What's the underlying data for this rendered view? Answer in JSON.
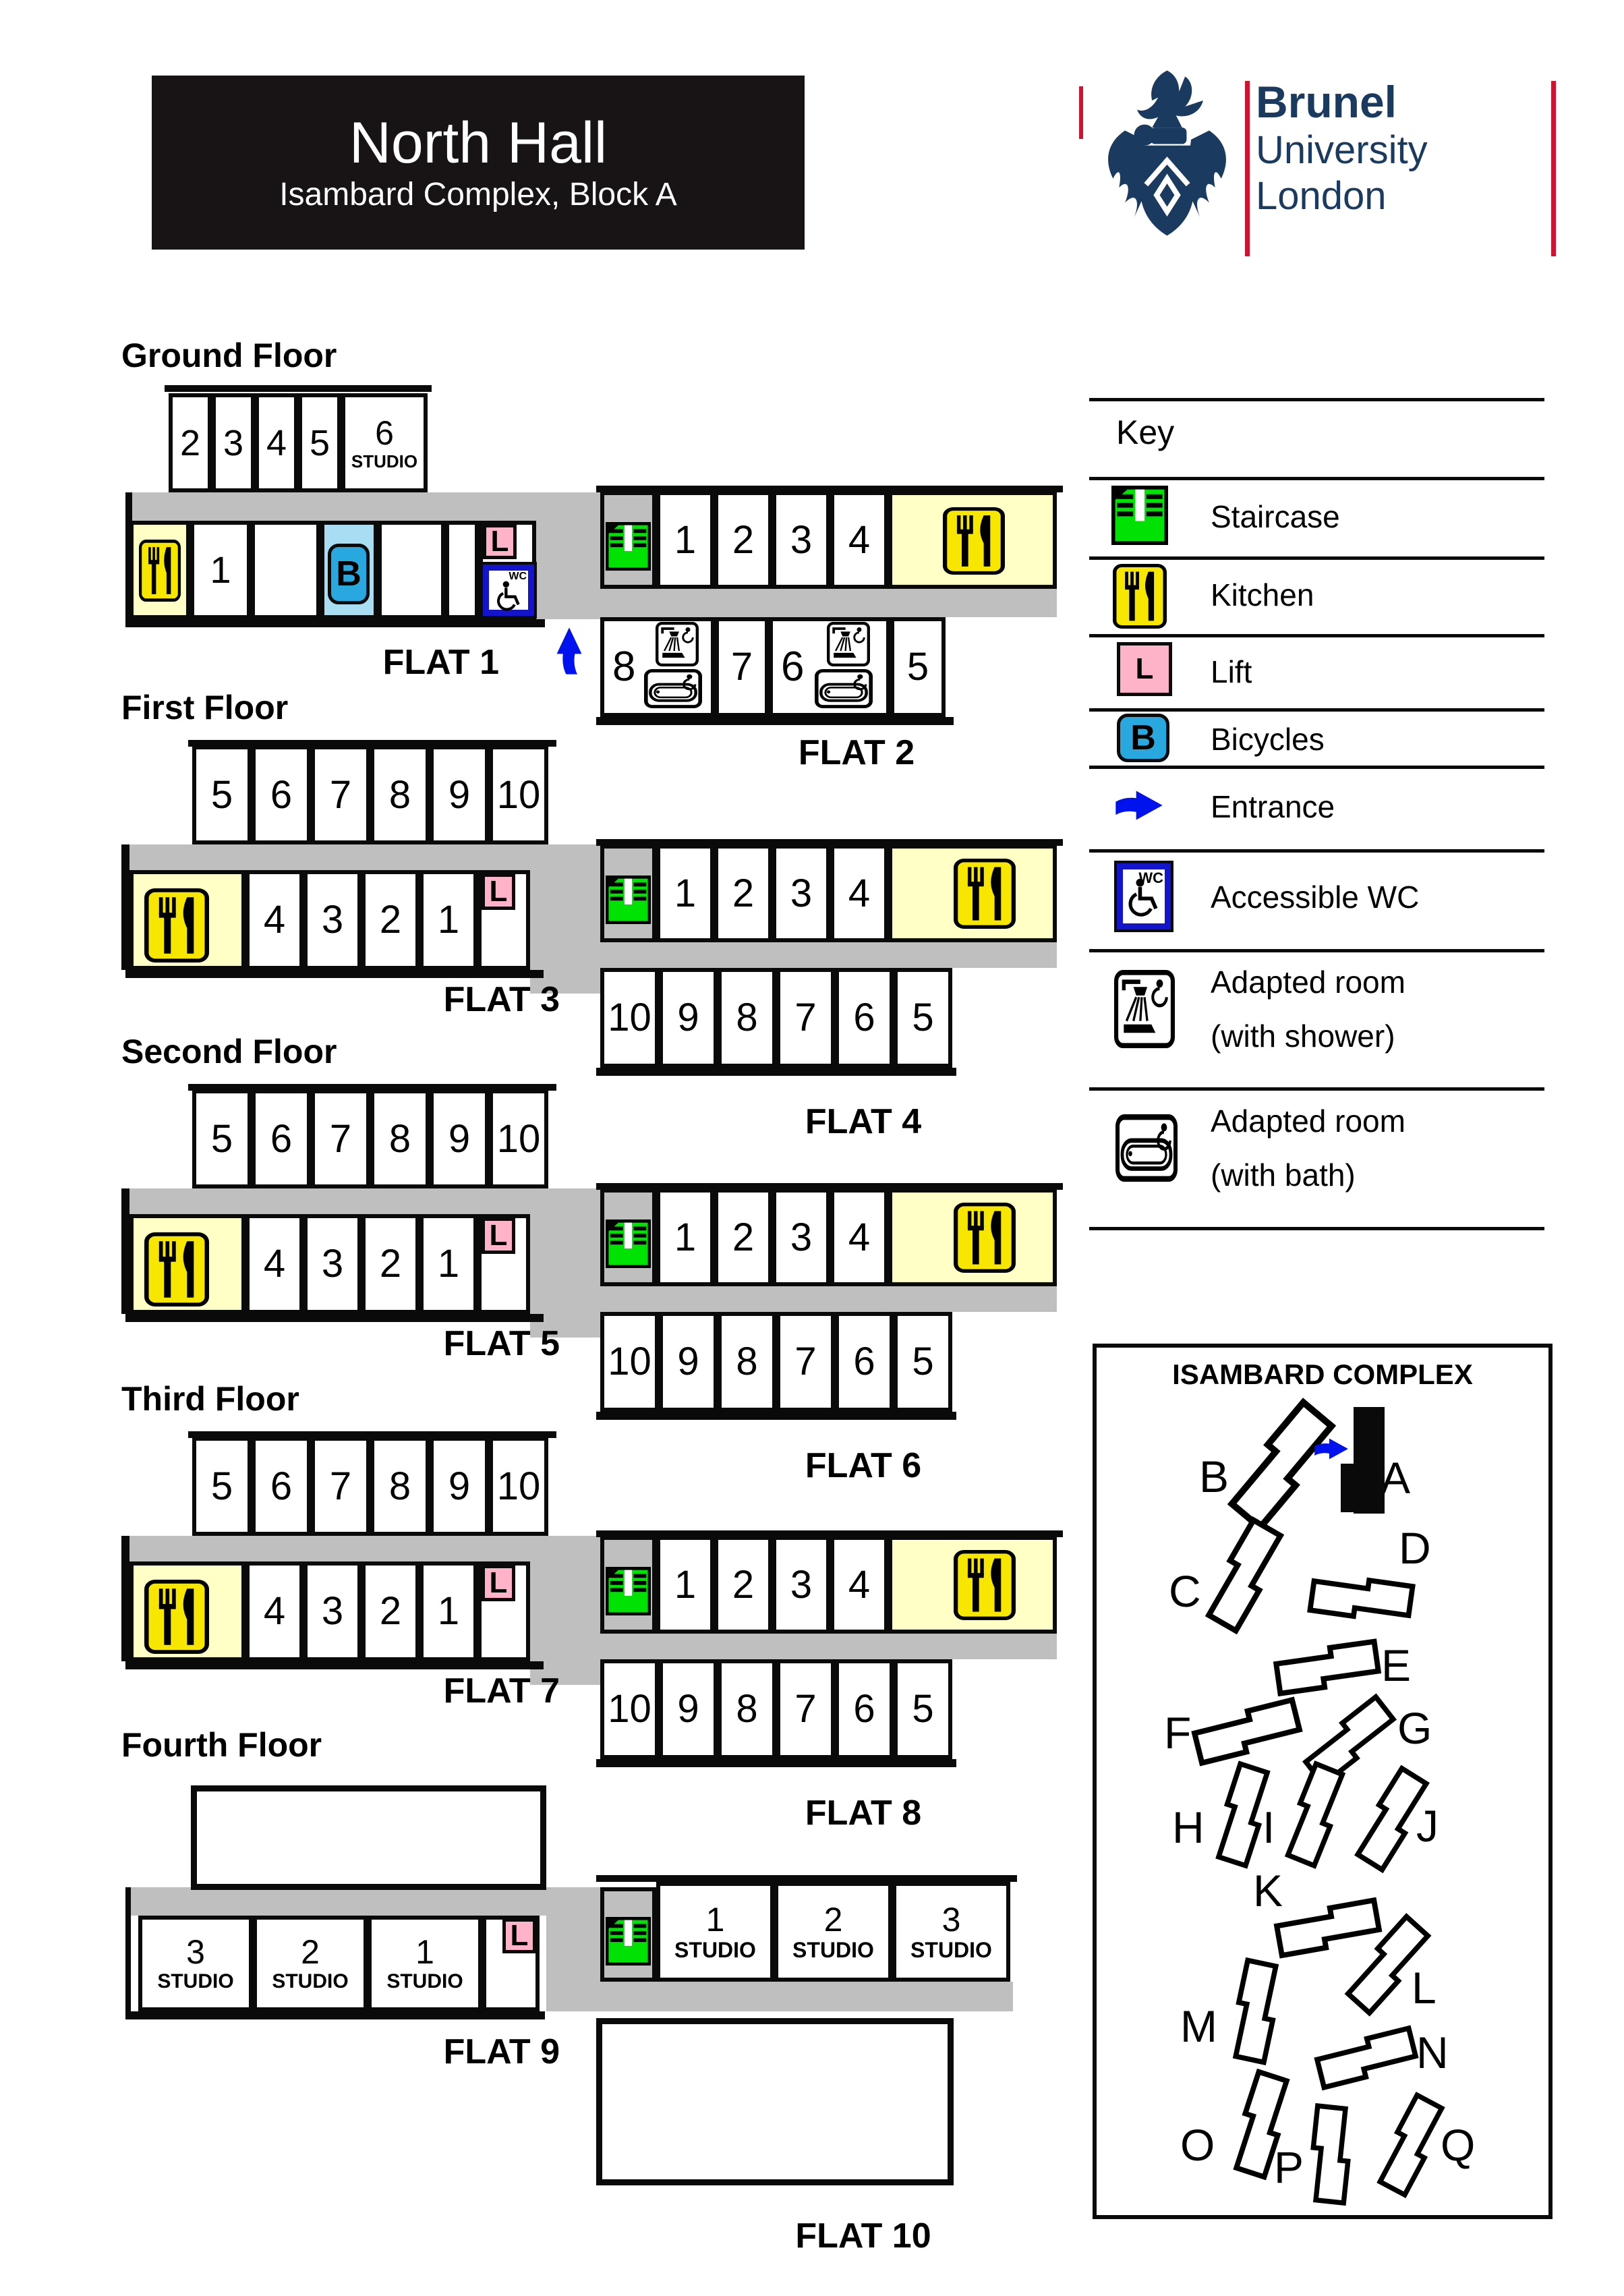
{
  "page": {
    "title": "North Hall",
    "subtitle": "Isambard Complex, Block A"
  },
  "logo": {
    "brand_lines": [
      "Brunel",
      "University",
      "London"
    ]
  },
  "key": {
    "heading": "Key",
    "items": [
      {
        "icon": "staircase-icon",
        "label": "Staircase"
      },
      {
        "icon": "kitchen-icon",
        "label": "Kitchen"
      },
      {
        "icon": "lift-icon",
        "label": "Lift",
        "glyph": "L"
      },
      {
        "icon": "bicycles-icon",
        "label": "Bicycles",
        "glyph": "B"
      },
      {
        "icon": "entrance-icon",
        "label": "Entrance"
      },
      {
        "icon": "accessible-wc-icon",
        "label": "Accessible WC",
        "glyph": "WC"
      },
      {
        "icon": "adapted-shower-icon",
        "label": "Adapted room",
        "label2": "(with shower)"
      },
      {
        "icon": "adapted-bath-icon",
        "label": "Adapted room",
        "label2": "(with bath)"
      }
    ]
  },
  "floors": [
    {
      "label": "Ground Floor",
      "flat_left": "FLAT 1",
      "flat_right": "FLAT 2",
      "left_top_rooms": [
        "2",
        "3",
        "4",
        "5"
      ],
      "left_top_studio_num": "6",
      "left_top_studio_text": "STUDIO",
      "room1": "1",
      "bicycles_glyph": "B",
      "lift_glyph": "L",
      "wc_glyph": "WC",
      "right_top_rooms": [
        "1",
        "2",
        "3",
        "4"
      ],
      "right_bottom_rooms": [
        "8",
        "7",
        "6",
        "5"
      ]
    },
    {
      "label": "First Floor",
      "flat_left": "FLAT 3",
      "flat_right": "FLAT 4",
      "left_top_rooms": [
        "5",
        "6",
        "7",
        "8",
        "9",
        "10"
      ],
      "left_bottom_rooms": [
        "4",
        "3",
        "2",
        "1"
      ],
      "lift_glyph": "L",
      "right_top_rooms": [
        "1",
        "2",
        "3",
        "4"
      ],
      "right_bottom_rooms": [
        "10",
        "9",
        "8",
        "7",
        "6",
        "5"
      ]
    },
    {
      "label": "Second Floor",
      "flat_left": "FLAT 5",
      "flat_right": "FLAT 6",
      "left_top_rooms": [
        "5",
        "6",
        "7",
        "8",
        "9",
        "10"
      ],
      "left_bottom_rooms": [
        "4",
        "3",
        "2",
        "1"
      ],
      "lift_glyph": "L",
      "right_top_rooms": [
        "1",
        "2",
        "3",
        "4"
      ],
      "right_bottom_rooms": [
        "10",
        "9",
        "8",
        "7",
        "6",
        "5"
      ]
    },
    {
      "label": "Third Floor",
      "flat_left": "FLAT 7",
      "flat_right": "FLAT 8",
      "left_top_rooms": [
        "5",
        "6",
        "7",
        "8",
        "9",
        "10"
      ],
      "left_bottom_rooms": [
        "4",
        "3",
        "2",
        "1"
      ],
      "lift_glyph": "L",
      "right_top_rooms": [
        "1",
        "2",
        "3",
        "4"
      ],
      "right_bottom_rooms": [
        "10",
        "9",
        "8",
        "7",
        "6",
        "5"
      ]
    },
    {
      "label": "Fourth Floor",
      "flat_left": "FLAT 9",
      "flat_right": "FLAT 10",
      "left_bottom_studios": [
        {
          "num": "3",
          "text": "STUDIO"
        },
        {
          "num": "2",
          "text": "STUDIO"
        },
        {
          "num": "1",
          "text": "STUDIO"
        }
      ],
      "lift_glyph": "L",
      "right_top_studios": [
        {
          "num": "1",
          "text": "STUDIO"
        },
        {
          "num": "2",
          "text": "STUDIO"
        },
        {
          "num": "3",
          "text": "STUDIO"
        }
      ]
    }
  ],
  "map": {
    "title": "ISAMBARD COMPLEX",
    "blocks": [
      "B",
      "A",
      "C",
      "D",
      "E",
      "F",
      "G",
      "H",
      "I",
      "J",
      "K",
      "L",
      "M",
      "N",
      "O",
      "P",
      "Q"
    ]
  },
  "colors": {
    "corridor": "#bfbfbf",
    "kitchen_icon": "#f7e700",
    "kitchen_room": "#ffffc6",
    "staircase": "#00e104",
    "lift": "#ffb3c8",
    "bicycles": "#29a8e0",
    "accessible_wc": "#1414cc",
    "entrance_arrow": "#0013ee",
    "brand_navy": "#1a3a5f",
    "brand_red": "#cc1433"
  }
}
